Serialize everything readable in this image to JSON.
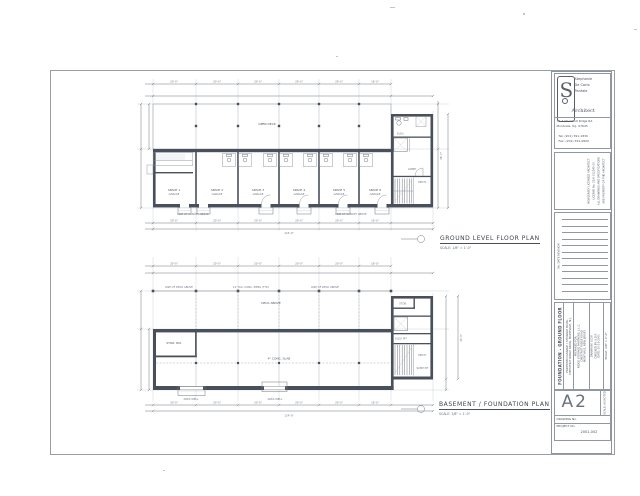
{
  "titleblock": {
    "architect": {
      "name_line1": "Stephanie",
      "name_line2": "De Carlo",
      "name_line3": "Pantale",
      "title": "Architect",
      "address1": "79-2 Chestnut Ridge Rd.",
      "address2": "Montvale, N.J. 07645",
      "tel": "Tel: (201) 391-1830",
      "fax": "Fax: (201) 391-0600"
    },
    "license_lines": [
      "NEW JERSEY LICENSED ARCHITECT",
      "LICENSE No. 21AI 012345 00",
      "ALL DRAWINGS AND SPECIFICATIONS",
      "ARE PROPERTY OF THE ARCHITECT"
    ],
    "revision_header": "No.   DATE   REVISION",
    "project": {
      "drawing_title": "FOUNDATION - GROUND FLOOR",
      "project_line1": "PROPOSED GARAGE / STORAGE BLDG.",
      "project_line2": "CHESTNUT RIDGE ROAD, MONTVALE, N.J.",
      "prepared_lines": [
        "PREPARED FOR:",
        "RIDGE STORAGE PARTNERS, L.L.C.",
        "CHESTNUT RIDGE ROAD",
        "MONTVALE, NEW JERSEY"
      ],
      "info_lines": [
        "DRAWN BY: S.D.P.",
        "CHECKED BY: S.D.P.",
        "DATE: 10-15-2001"
      ],
      "date_scale": "SCALE: 1/8\" = 1'-0\""
    },
    "sheet": {
      "number": "A2",
      "strip": "SCALE: AS NOTED",
      "drawing_no_label": "DRAWING No.",
      "project_no_label": "PROJECT No.",
      "project_no": "2001-002"
    }
  },
  "plans": {
    "ground": {
      "title": "GROUND LEVEL FLOOR PLAN",
      "scale": "SCALE: 1/8\" = 1'-0\"",
      "deck_label": "OPEN DECK",
      "units": [
        "SPACE 1",
        "SPACE 2",
        "SPACE 3",
        "SPACE 4",
        "SPACE 5",
        "SPACE 6"
      ],
      "unit_sub": "GARAGE",
      "canopy_label": "LINE OF CANOPY ABOVE",
      "wing": {
        "lobby": "LOBBY",
        "mech": "MECH.",
        "elev": "ELEV.",
        "stair": "STAIR"
      },
      "dims": {
        "bays": [
          "20'-0\"",
          "20'-0\"",
          "20'-0\"",
          "20'-0\"",
          "20'-0\"",
          "16'-0\""
        ],
        "total": "124'-0\"",
        "right": "36'-0\""
      }
    },
    "basement": {
      "title": "BASEMENT / FOUNDATION PLAN",
      "scale": "SCALE: 1/8\" = 1'-0\"",
      "pier_labels": [
        "LINE OF DECK ABOVE",
        "12\" DIA. CONC. PIERS (TYP.)",
        "LINE OF DECK ABOVE"
      ],
      "deck_label": "DECK ABOVE",
      "storage_label": "STOR. RM.",
      "slab_label": "4\" CONC. SLAB",
      "well_label": "AREA WELL",
      "wing": {
        "stor": "STOR.",
        "elev_pit": "ELEV. PIT",
        "mech": "MECH.",
        "sump": "SUMP PIT"
      },
      "dims": {
        "bays": [
          "20'-0\"",
          "20'-0\"",
          "20'-0\"",
          "20'-0\"",
          "20'-0\"",
          "16'-0\""
        ],
        "total": "124'-0\"",
        "right": "33'-4\""
      }
    }
  }
}
